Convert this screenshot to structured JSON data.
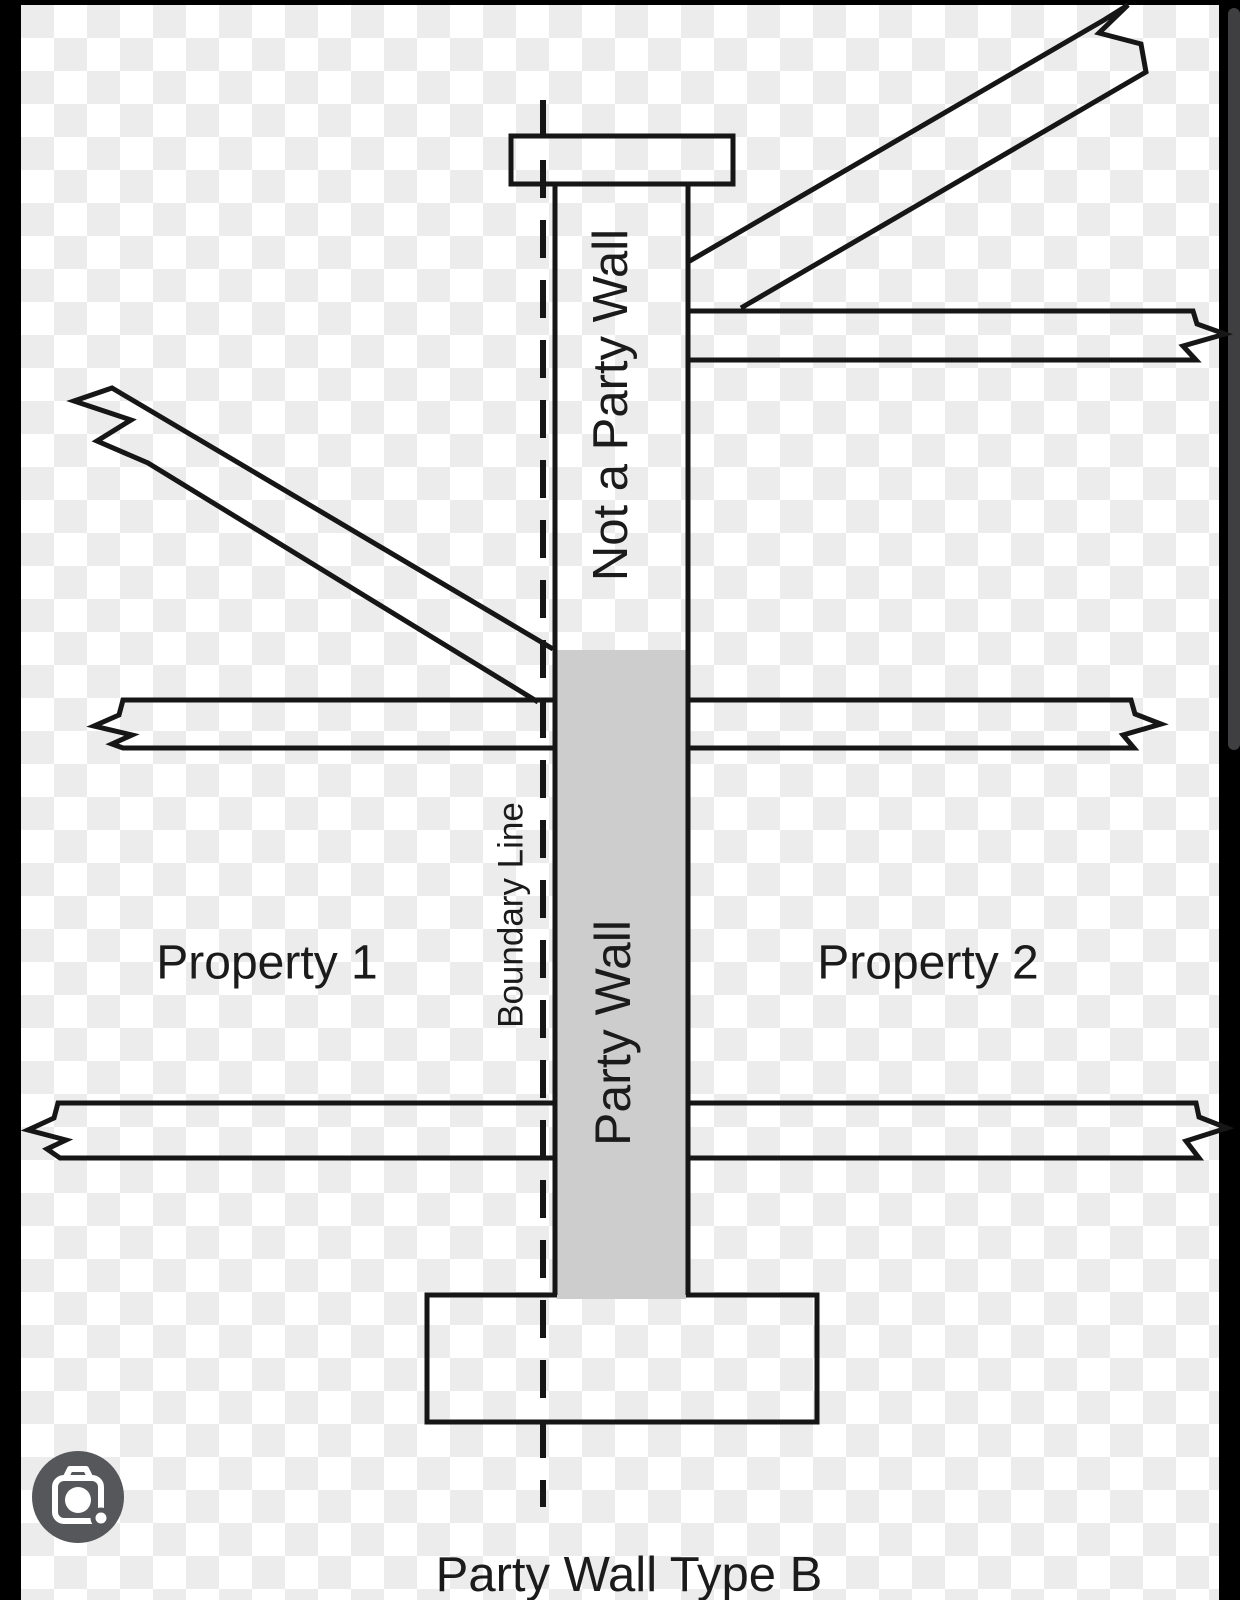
{
  "diagram": {
    "labels": {
      "not_a_party_wall": "Not a Party Wall",
      "boundary_line": "Boundary Line",
      "party_wall": "Party Wall",
      "property_1": "Property 1",
      "property_2": "Property 2",
      "caption": "Party Wall Type B"
    },
    "colors": {
      "line": "#161616",
      "party_wall_fill": "#cdcdcd",
      "checker_square": "#ececec",
      "checker_base": "#ffffff",
      "letterbox_bar": "#000000",
      "scrollbar_thumb": "#3f3f41",
      "lens_button_bg": "#56575a",
      "lens_glyph": "#ffffff"
    }
  },
  "viewer": {
    "icons": {
      "lens_camera": "camera-lens-icon"
    }
  }
}
